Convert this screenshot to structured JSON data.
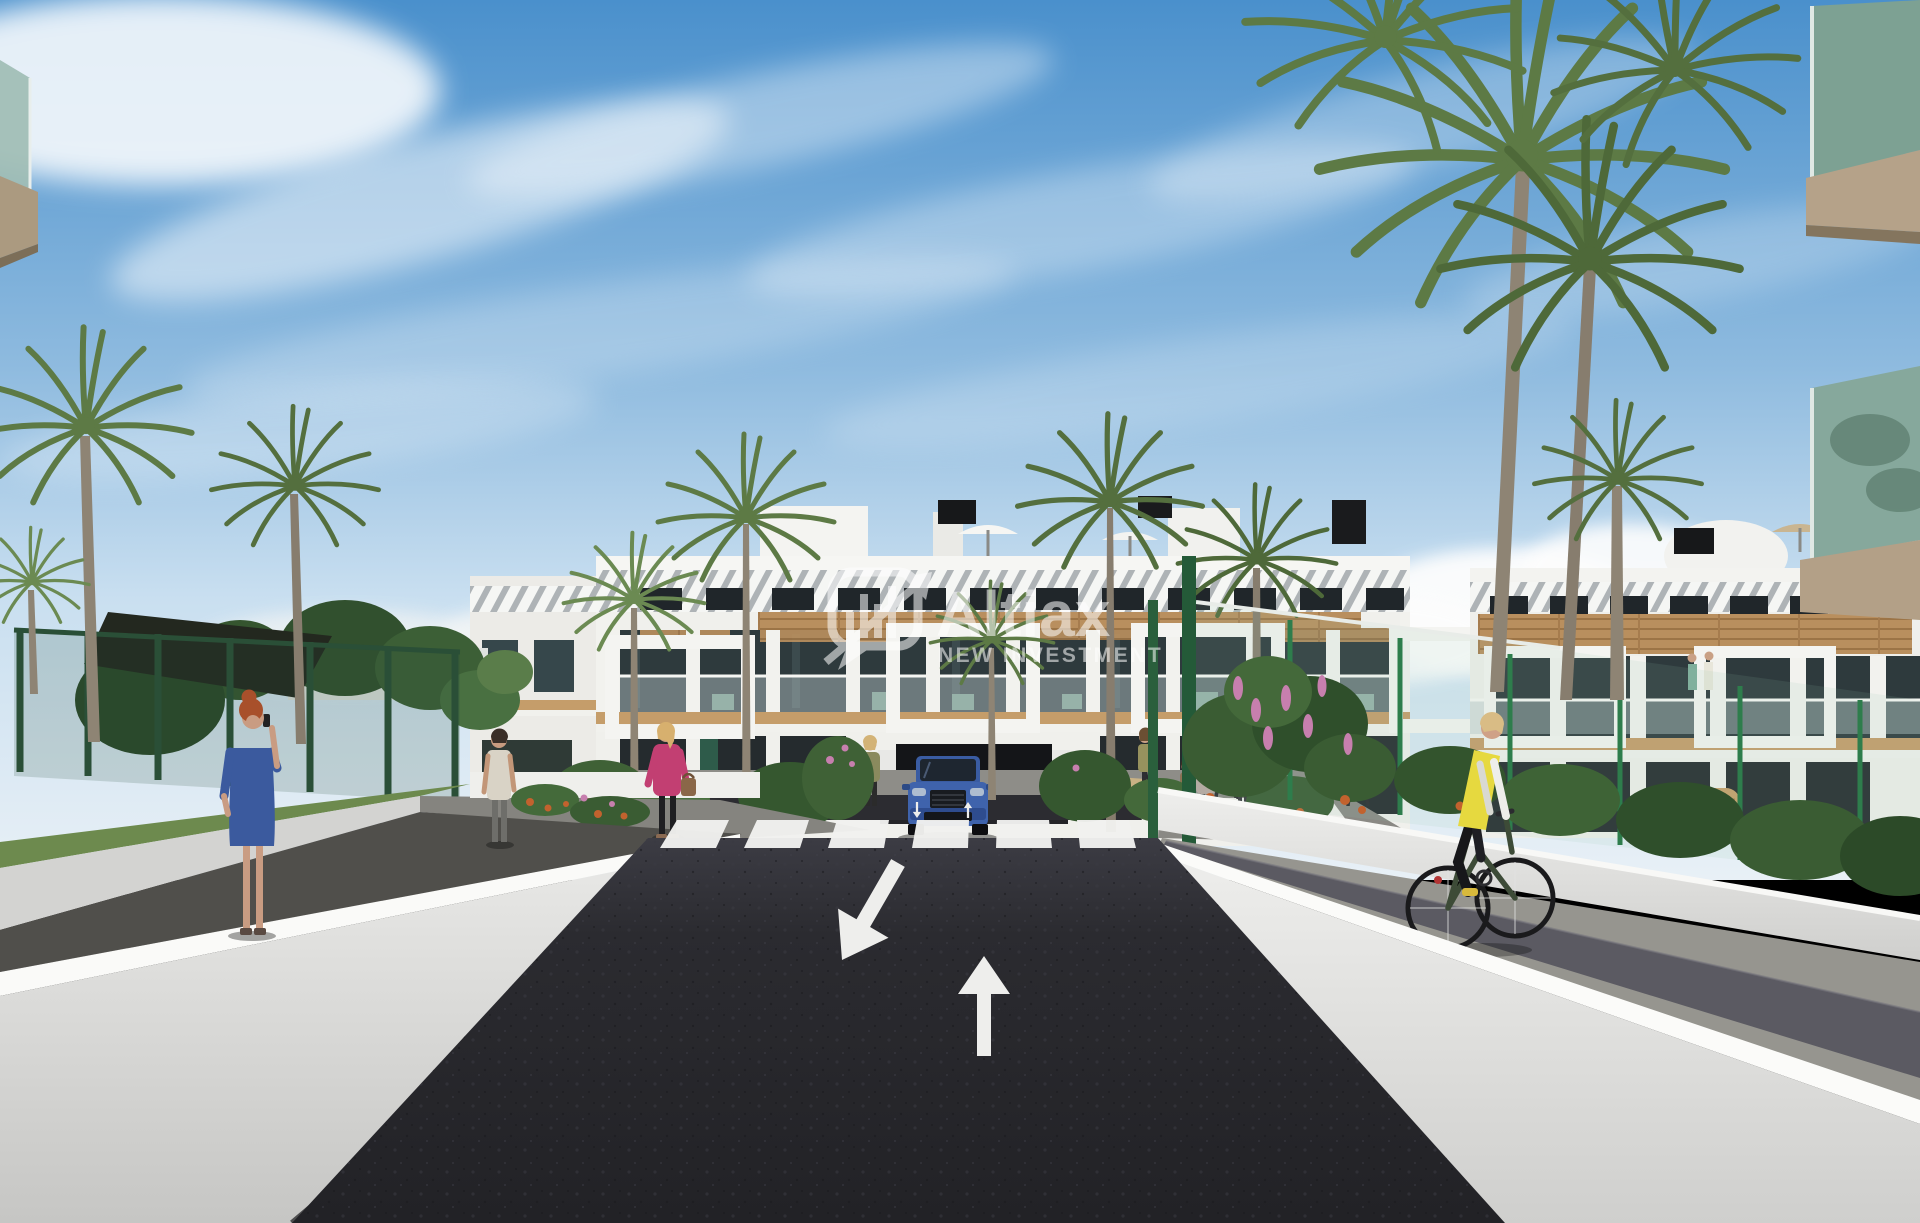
{
  "image": {
    "kind": "3d-architectural-render",
    "subject": "Street-level render of a modern white apartment complex with wood accents, palm trees, pedestrians, a cyclist and a blue SUV at a garage ramp",
    "width_px": 1920,
    "height_px": 1223
  },
  "watermark": {
    "brand": "Altiax",
    "tagline": "NEW INVESTMENT",
    "icon": "chat-bubble-equalizer-arrow-icon",
    "color": "#ffffff",
    "opacity": 0.55
  },
  "road": {
    "surface": "dark asphalt",
    "lane_arrows": [
      "down-left",
      "up"
    ],
    "small_painted_arrows": [
      "down",
      "up"
    ],
    "crosswalk_stripe_count": 6
  },
  "vehicles": [
    {
      "id": "blue-suv",
      "color": "#3f63ac",
      "location": "garage ramp below building center",
      "facing": "toward viewer"
    }
  ],
  "people": [
    {
      "id": "woman-blue-dress",
      "pose": "standing on left walkway, phone to ear",
      "hair": "#a8502b",
      "dress": "#3b5a9e"
    },
    {
      "id": "woman-pink-jacket",
      "pose": "walking left with brown handbag",
      "hair": "#d7b06e",
      "jacket": "#c23f72",
      "pants": "#1f1f22",
      "bag": "#8a6748"
    },
    {
      "id": "man-beige-top",
      "pose": "walking away on left path",
      "top": "#d9d3c6",
      "pants": "#6e6e6a"
    },
    {
      "id": "woman-olive-top",
      "pose": "standing by entrance planter",
      "top": "#8a8a5e"
    },
    {
      "id": "woman-with-bicycle",
      "pose": "standing with bicycle near racks",
      "top": "#97925e"
    },
    {
      "id": "woman-with-child",
      "pose": "standing with child near entrance",
      "top": "#b9a8a2"
    },
    {
      "id": "child",
      "pose": "standing",
      "top": "#8a7355"
    },
    {
      "id": "woman-teal-top",
      "pose": "standing near bike racks",
      "top": "#7e9a94"
    },
    {
      "id": "cyclist-yellow-vest",
      "pose": "riding away on right side path",
      "hair": "#d9bc85",
      "vest": "#e6d93f",
      "sleeves": "#eeeeea",
      "leggings": "#17171a",
      "bike": "#3d4b37"
    },
    {
      "id": "terrace-couple",
      "pose": "standing on right wing first-floor terrace"
    }
  ],
  "architecture": {
    "building": "three-storey white complex with louvered roof band, timber cladding band, glass balustrades, white portal frames, rooftop parasols and vents",
    "foreground_corners": "glass balcony corners with tan slabs at top-left and top-right",
    "garage": "dark basement ramp opening at center",
    "bike_racks": 7
  },
  "landscape": {
    "palms": 14,
    "left": "dark green mesh fence, shade canopy, broadleaf trees, lawn strip",
    "right": "green mesh fence, flowering shrubs with pink spikes, wicker bench, cobbled path",
    "flowers": [
      "orange",
      "pink"
    ]
  },
  "palette": {
    "sky_top": "#4a90cc",
    "sky_mid": "#8fbbdf",
    "sky_horizon": "#e8f0f6",
    "cloud_white": "#ffffff",
    "asphalt_dark": "#26262a",
    "road_marking_white": "#f2f2f0",
    "wall_white": "#f2f2ee",
    "wall_gray": "#d7d7d5",
    "path_gray": "#96958f",
    "cobble_gray": "#5b5a62",
    "wood_accent": "#b98f5e",
    "glass_dark": "#2e3a3d",
    "balcony_glass_teal": "#86a89c",
    "slab_tan": "#b3a087",
    "fence_green_dark": "#2c5b3c",
    "fence_green_bright": "#2e8050",
    "lawn_green": "#6d8a4e",
    "palm_green": "#5d7a45",
    "palm_trunk": "#8e8474",
    "flower_orange": "#c2622e",
    "flower_pink": "#c77fae",
    "car_blue": "#3f63ac",
    "vest_yellow": "#e6d93f",
    "jacket_magenta": "#c23f72",
    "dress_blue": "#3b5a9e"
  }
}
